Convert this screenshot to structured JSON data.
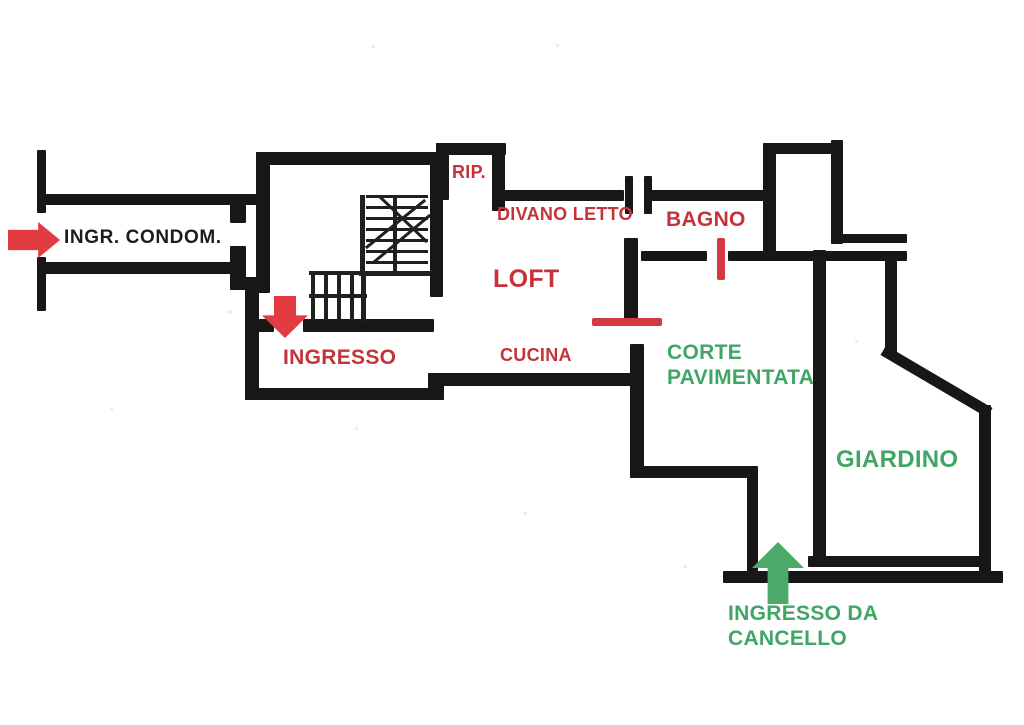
{
  "canvas": {
    "width": 1024,
    "height": 725,
    "background": "#ffffff"
  },
  "colors": {
    "wall": "#191715",
    "stair_line": "#221f1d",
    "red_text": "#c5333a",
    "black_text": "#1c1c1c",
    "green_text": "#41a566",
    "red_arrow": "#e23b42",
    "green_arrow": "#4caa68",
    "door_marker": "#d3393f"
  },
  "labels": [
    {
      "name": "label-ingr-condom",
      "text": "INGR. CONDOM.",
      "x": 64,
      "y": 227,
      "size": 19,
      "color": "black"
    },
    {
      "name": "label-rip",
      "text": "RIP.",
      "x": 452,
      "y": 162,
      "size": 18,
      "color": "red"
    },
    {
      "name": "label-divano-letto",
      "text": "DIVANO LETTO",
      "x": 497,
      "y": 204,
      "size": 18,
      "color": "red"
    },
    {
      "name": "label-loft",
      "text": "LOFT",
      "x": 493,
      "y": 265,
      "size": 25,
      "color": "red"
    },
    {
      "name": "label-bagno",
      "text": "BAGNO",
      "x": 666,
      "y": 208,
      "size": 21,
      "color": "red"
    },
    {
      "name": "label-ingresso",
      "text": "INGRESSO",
      "x": 283,
      "y": 346,
      "size": 21,
      "color": "red"
    },
    {
      "name": "label-cucina",
      "text": "CUCINA",
      "x": 500,
      "y": 345,
      "size": 18,
      "color": "red"
    },
    {
      "name": "label-corte-pavimentata",
      "text": "CORTE\nPAVIMENTATA",
      "x": 667,
      "y": 341,
      "size": 21,
      "color": "green"
    },
    {
      "name": "label-giardino",
      "text": "GIARDINO",
      "x": 836,
      "y": 446,
      "size": 24,
      "color": "green"
    },
    {
      "name": "label-ingresso-cancello",
      "text": "INGRESSO DA\nCANCELLO",
      "x": 728,
      "y": 602,
      "size": 21,
      "color": "green"
    }
  ],
  "arrows": [
    {
      "name": "entrance-arrow-condominio",
      "dir": "right",
      "color": "red",
      "x": 8,
      "y": 222,
      "w": 52,
      "h": 36
    },
    {
      "name": "entrance-arrow-ingresso",
      "dir": "down",
      "color": "red",
      "x": 262,
      "y": 296,
      "w": 46,
      "h": 42
    },
    {
      "name": "entrance-arrow-cancello",
      "dir": "up",
      "color": "green",
      "x": 752,
      "y": 542,
      "w": 52,
      "h": 62
    }
  ],
  "door_markers": [
    {
      "name": "door-marker-bagno",
      "x": 717,
      "y": 238,
      "w": 8,
      "h": 42
    },
    {
      "name": "door-marker-corte",
      "x": 592,
      "y": 318,
      "w": 70,
      "h": 8
    }
  ],
  "walls": [
    {
      "name": "wall-corridor-left-stub-upper",
      "x": 37,
      "y": 150,
      "w": 9,
      "h": 63
    },
    {
      "name": "wall-corridor-left-stub-lower",
      "x": 37,
      "y": 257,
      "w": 9,
      "h": 54
    },
    {
      "name": "wall-corridor-top",
      "x": 37,
      "y": 194,
      "w": 227,
      "h": 11
    },
    {
      "name": "wall-corridor-bottom",
      "x": 37,
      "y": 262,
      "w": 196,
      "h": 12
    },
    {
      "name": "wall-corridor-right-jamb-upper",
      "x": 230,
      "y": 194,
      "w": 16,
      "h": 29
    },
    {
      "name": "wall-corridor-right-jamb-lower",
      "x": 230,
      "y": 246,
      "w": 16,
      "h": 38
    },
    {
      "name": "wall-corridor-jog",
      "x": 230,
      "y": 277,
      "w": 30,
      "h": 13
    },
    {
      "name": "wall-stairsroom-top",
      "x": 256,
      "y": 152,
      "w": 184,
      "h": 13
    },
    {
      "name": "wall-stairsroom-left",
      "x": 256,
      "y": 152,
      "w": 14,
      "h": 141
    },
    {
      "name": "wall-stairsroom-right",
      "x": 430,
      "y": 152,
      "w": 13,
      "h": 145
    },
    {
      "name": "wall-stairsroom-bottom-left",
      "x": 256,
      "y": 319,
      "w": 18,
      "h": 13
    },
    {
      "name": "wall-stairsroom-bottom-right",
      "x": 303,
      "y": 319,
      "w": 131,
      "h": 13
    },
    {
      "name": "wall-ingresso-left",
      "x": 245,
      "y": 288,
      "w": 14,
      "h": 112
    },
    {
      "name": "wall-ingresso-bottom",
      "x": 245,
      "y": 388,
      "w": 199,
      "h": 12
    },
    {
      "name": "wall-cucina-step",
      "x": 428,
      "y": 373,
      "w": 16,
      "h": 27
    },
    {
      "name": "wall-cucina-bottom",
      "x": 428,
      "y": 373,
      "w": 211,
      "h": 13
    },
    {
      "name": "wall-rip-top",
      "x": 436,
      "y": 143,
      "w": 70,
      "h": 12
    },
    {
      "name": "wall-rip-left",
      "x": 436,
      "y": 143,
      "w": 13,
      "h": 57
    },
    {
      "name": "wall-rip-right",
      "x": 492,
      "y": 143,
      "w": 13,
      "h": 68
    },
    {
      "name": "wall-loft-top",
      "x": 497,
      "y": 190,
      "w": 127,
      "h": 11
    },
    {
      "name": "wall-loft-door-stub-1",
      "x": 625,
      "y": 176,
      "w": 8,
      "h": 38
    },
    {
      "name": "wall-loft-door-stub-2",
      "x": 644,
      "y": 176,
      "w": 8,
      "h": 38
    },
    {
      "name": "wall-bagno-top",
      "x": 651,
      "y": 190,
      "w": 118,
      "h": 11
    },
    {
      "name": "wall-bagno-right-vertical",
      "x": 763,
      "y": 143,
      "w": 13,
      "h": 118
    },
    {
      "name": "wall-topright-horizontal",
      "x": 763,
      "y": 143,
      "w": 79,
      "h": 11
    },
    {
      "name": "wall-topright-vertical",
      "x": 831,
      "y": 140,
      "w": 12,
      "h": 104
    },
    {
      "name": "wall-bagno-double-upper",
      "x": 831,
      "y": 234,
      "w": 76,
      "h": 9
    },
    {
      "name": "wall-bagno-bottom-left",
      "x": 641,
      "y": 251,
      "w": 66,
      "h": 10
    },
    {
      "name": "wall-bagno-bottom-right",
      "x": 728,
      "y": 251,
      "w": 179,
      "h": 10
    },
    {
      "name": "wall-corte-left-upper",
      "x": 624,
      "y": 238,
      "w": 14,
      "h": 88
    },
    {
      "name": "wall-corte-left-lower",
      "x": 630,
      "y": 344,
      "w": 14,
      "h": 134
    },
    {
      "name": "wall-corte-bottom",
      "x": 630,
      "y": 466,
      "w": 128,
      "h": 12
    },
    {
      "name": "wall-gate-left-vertical",
      "x": 747,
      "y": 472,
      "w": 11,
      "h": 106
    },
    {
      "name": "wall-outer-bottom",
      "x": 723,
      "y": 571,
      "w": 280,
      "h": 12
    },
    {
      "name": "wall-giardino-bottom",
      "x": 808,
      "y": 556,
      "w": 181,
      "h": 11
    },
    {
      "name": "wall-giardino-left",
      "x": 813,
      "y": 250,
      "w": 13,
      "h": 313
    },
    {
      "name": "wall-giardino-topright-vertical",
      "x": 885,
      "y": 253,
      "w": 12,
      "h": 104
    },
    {
      "name": "wall-giardino-right",
      "x": 979,
      "y": 405,
      "w": 12,
      "h": 172
    }
  ],
  "stair_lines": [
    {
      "x": 366,
      "y": 195,
      "w": 62,
      "h": 3
    },
    {
      "x": 366,
      "y": 206,
      "w": 62,
      "h": 3
    },
    {
      "x": 366,
      "y": 217,
      "w": 62,
      "h": 3
    },
    {
      "x": 366,
      "y": 228,
      "w": 62,
      "h": 3
    },
    {
      "x": 366,
      "y": 239,
      "w": 62,
      "h": 3
    },
    {
      "x": 366,
      "y": 250,
      "w": 62,
      "h": 3
    },
    {
      "x": 366,
      "y": 261,
      "w": 62,
      "h": 3
    },
    {
      "x": 359,
      "y": 271,
      "w": 71,
      "h": 5
    },
    {
      "x": 360,
      "y": 195,
      "w": 5,
      "h": 81
    },
    {
      "x": 393,
      "y": 195,
      "w": 4,
      "h": 80
    },
    {
      "x": 309,
      "y": 271,
      "w": 58,
      "h": 4
    },
    {
      "x": 309,
      "y": 294,
      "w": 58,
      "h": 4
    },
    {
      "x": 311,
      "y": 273,
      "w": 4,
      "h": 48
    },
    {
      "x": 324,
      "y": 273,
      "w": 4,
      "h": 48
    },
    {
      "x": 337,
      "y": 273,
      "w": 4,
      "h": 48
    },
    {
      "x": 350,
      "y": 273,
      "w": 4,
      "h": 48
    },
    {
      "x": 361,
      "y": 273,
      "w": 5,
      "h": 48
    }
  ],
  "diagonals": [
    {
      "name": "stair-direction-line-1",
      "x1": 367,
      "y1": 247,
      "x2": 424,
      "y2": 201,
      "w": 3,
      "color": "stair_line"
    },
    {
      "name": "stair-direction-line-2",
      "x1": 374,
      "y1": 262,
      "x2": 429,
      "y2": 216,
      "w": 3,
      "color": "stair_line"
    },
    {
      "name": "stair-direction-line-3",
      "x1": 426,
      "y1": 241,
      "x2": 380,
      "y2": 197,
      "w": 3,
      "color": "stair_line"
    },
    {
      "name": "wall-giardino-diagonal",
      "x1": 888,
      "y1": 353,
      "x2": 985,
      "y2": 410,
      "w": 11,
      "color": "wall"
    }
  ],
  "noise_dots": [
    {
      "x": 372,
      "y": 45,
      "r": 3
    },
    {
      "x": 556,
      "y": 44,
      "r": 3
    },
    {
      "x": 228,
      "y": 310,
      "r": 4
    },
    {
      "x": 855,
      "y": 340,
      "r": 3
    },
    {
      "x": 110,
      "y": 408,
      "r": 3
    },
    {
      "x": 686,
      "y": 369,
      "r": 3
    },
    {
      "x": 524,
      "y": 512,
      "r": 3
    },
    {
      "x": 355,
      "y": 427,
      "r": 3
    },
    {
      "x": 684,
      "y": 565,
      "r": 3
    }
  ]
}
